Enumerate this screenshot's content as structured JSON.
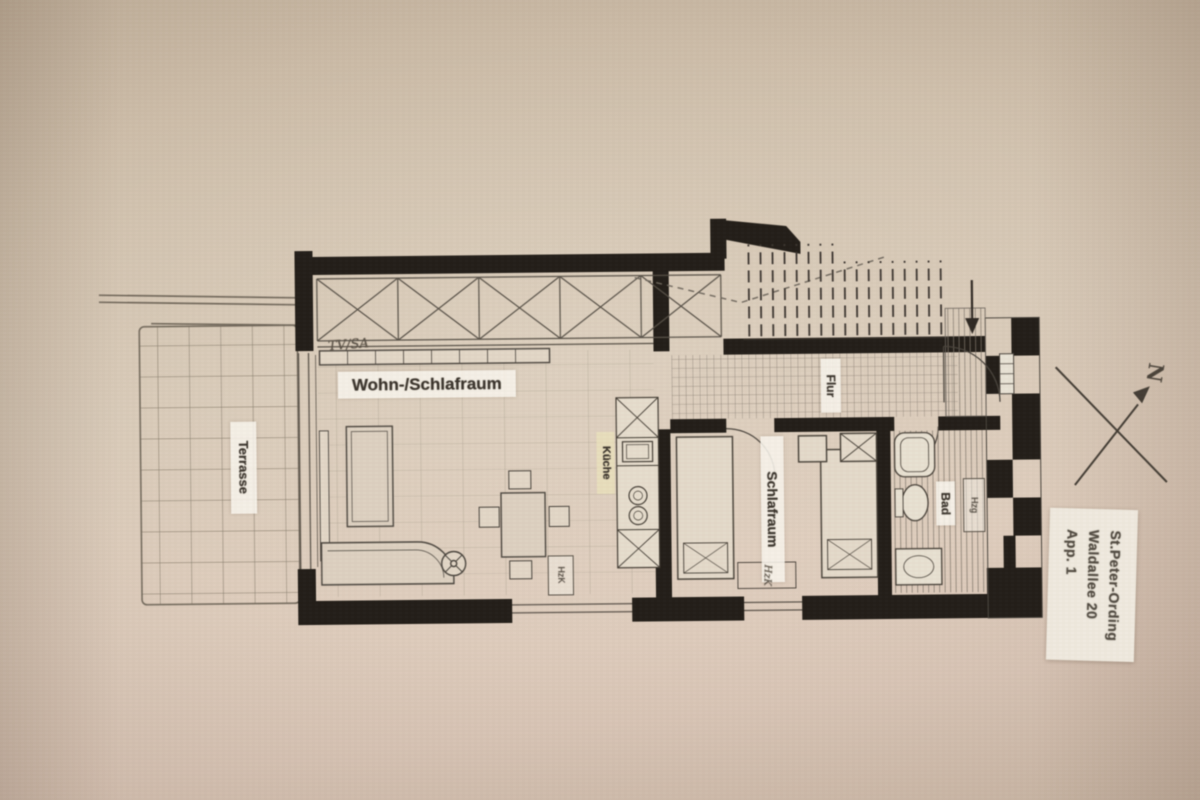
{
  "labels": {
    "terrasse": "Terrasse",
    "wohn_schlafraum": "Wohn-/Schlafraum",
    "tv_sa": "TV/SA",
    "kueche": "Küche",
    "flur": "Flur",
    "schlafraum": "Schlafraum",
    "bad": "Bad",
    "hzk_wohnraum": "HzK",
    "hzk_schlafraum": "HzK",
    "hzg_bad": "Hzg",
    "north": "N"
  },
  "title_block": {
    "lines": [
      "St.Peter-Ording",
      "Waldallee 20",
      "App. 1"
    ]
  },
  "colors": {
    "paper": "#d5c6b4",
    "ink": "#332c24",
    "wall_fill": "#221d17",
    "label_bg": "#f4efe4",
    "kueche_label_bg": "#eadfb9"
  }
}
